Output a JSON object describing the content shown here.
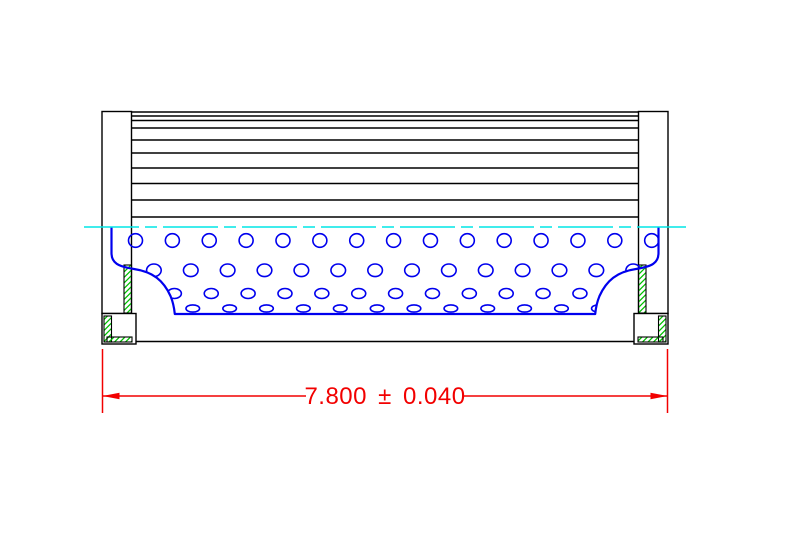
{
  "drawing": {
    "type": "cad-cross-section",
    "part": "filter-element-side-view",
    "canvas": {
      "width": 789,
      "height": 546,
      "background": "#ffffff"
    },
    "colors": {
      "outline": "#000000",
      "media_blue": "#0000ee",
      "centerline_cyan": "#00e6e6",
      "hatch_green": "#00c000",
      "dimension_red": "#f20000"
    },
    "stroke_widths": {
      "black": 1.4,
      "blue_outline": 2.2,
      "blue_hole": 1.6,
      "cyan": 1.6,
      "red": 1.5,
      "hatch_border": 1.1
    },
    "mirror_sum": 770,
    "pleats": {
      "x1": 130,
      "x2": 640,
      "line_ys": [
        112,
        116,
        120.5,
        128,
        140,
        153,
        168,
        183.5,
        200,
        217
      ]
    },
    "cap": {
      "solids": [
        {
          "name": "wall",
          "x": 102,
          "y": 111.5,
          "w": 29.5,
          "h": 202
        },
        {
          "name": "foot",
          "x": 102,
          "y": 313.5,
          "w": 34,
          "h": 30.5
        }
      ],
      "hatches": [
        {
          "name": "wall-seal-hatch",
          "x": 124,
          "y": 265,
          "w": 7.5,
          "h": 48
        },
        {
          "name": "foot-side-hatch",
          "x": 104,
          "y": 316,
          "w": 7.5,
          "h": 26
        },
        {
          "name": "foot-bottom-hatch",
          "x": 107,
          "y": 337,
          "w": 25,
          "h": 5
        }
      ]
    },
    "bottom_edge": {
      "x1": 136,
      "x2": 634,
      "y": 341.5
    },
    "tube": {
      "outline_d": "M 111.5,227 L 111.5,253 C 111.5,263 118,266.5 134,269 C 153,271.8 163.5,280.5 170.5,296 C 172.8,301.5 174.2,308 174.8,314 L 595.2,314 C 595.8,308 597.2,301.5 599.5,296 C 606.5,280.5 617,271.8 636,269 C 652,266.5 658.5,263 658.5,253 L 658.5,227",
      "clip_d": "M 111.5,227 L 111.5,253 C 111.5,263 118,266.5 134,269 C 153,271.8 163.5,280.5 170.5,296 C 172.8,301.5 174.2,308 174.8,314 L 595.2,314 C 595.8,308 597.2,301.5 599.5,296 C 606.5,280.5 617,271.8 636,269 C 652,266.5 658.5,263 658.5,253 L 658.5,219 L 111.5,219 Z",
      "hole_rows": [
        {
          "y": 240.5,
          "rx": 7.0,
          "ry": 6.8,
          "x0": 135.5,
          "dx": 36.87,
          "count": 15
        },
        {
          "y": 270.3,
          "rx": 7.3,
          "ry": 6.3,
          "x0": 153.9,
          "dx": 36.87,
          "count": 14
        },
        {
          "y": 293.5,
          "rx": 7.0,
          "ry": 5.0,
          "x0": 137.5,
          "dx": 36.87,
          "count": 14
        },
        {
          "y": 308.5,
          "rx": 6.8,
          "ry": 3.6,
          "x0": 155.9,
          "dx": 36.87,
          "count": 13
        }
      ]
    },
    "centerline": {
      "x1": 84,
      "x2": 686,
      "y": 227,
      "dash": "55 6 12 6"
    },
    "dimension": {
      "label": "7.800 ± 0.040",
      "value": "7.800",
      "tolerance": "±0.040",
      "ext_lines": [
        {
          "x": 102.5,
          "y1": 349,
          "y2": 413
        },
        {
          "x": 667.5,
          "y1": 349,
          "y2": 413
        }
      ],
      "line_y": 396,
      "line_segments": [
        {
          "x1": 102.5,
          "x2": 306
        },
        {
          "x1": 464,
          "x2": 667.5
        }
      ],
      "arrows": [
        {
          "tip": [
            102.5,
            396
          ],
          "dir": 1
        },
        {
          "tip": [
            667.5,
            396
          ],
          "dir": -1
        }
      ],
      "arrow_len": 17,
      "arrow_half_w": 3.2,
      "text_x": 385,
      "text_y": 404,
      "font_size": 24
    }
  }
}
